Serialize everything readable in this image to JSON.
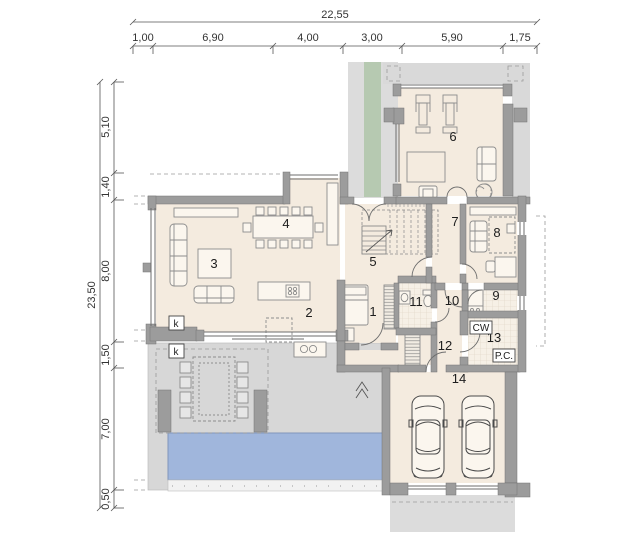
{
  "plan": {
    "type": "architectural-floor-plan-ground-floor",
    "dim_top": {
      "total": "22,55",
      "segments": [
        "1,00",
        "6,90",
        "4,00",
        "3,00",
        "5,90",
        "1,75"
      ]
    },
    "dim_left": {
      "total": "23,50",
      "segments": [
        "5,10",
        "1,40",
        "8,00",
        "1,50",
        "7,00",
        "0,50"
      ]
    },
    "rooms": [
      "1",
      "2",
      "3",
      "4",
      "5",
      "6",
      "7",
      "8",
      "9",
      "10",
      "11",
      "12",
      "13",
      "14"
    ],
    "marks": {
      "fireplace_interior": "k",
      "fireplace_terrace": "k",
      "hot_water_tank": "CW",
      "boiler": "P.C."
    },
    "colors": {
      "floor": "#f4ebdf",
      "wall": "#9c9c9c",
      "terrace": "#d7d7d7",
      "walkway": "#dcdcdc",
      "green_strip": "#b6c9b1",
      "pool": "#a0b6dc",
      "tile": "#f6f0e6"
    }
  }
}
